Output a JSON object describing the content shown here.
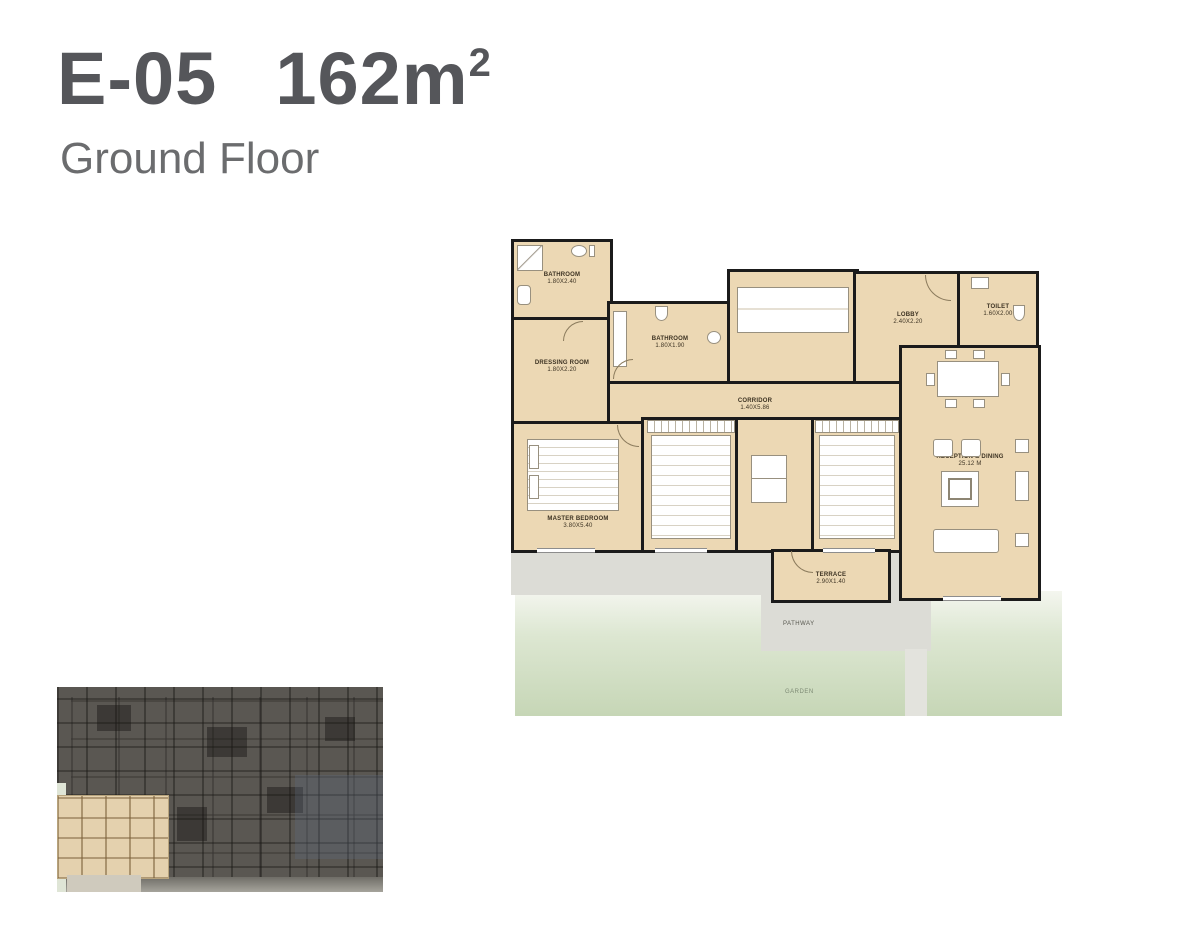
{
  "header": {
    "unit_code": "E-05",
    "area_value": "162m",
    "area_sup": "2",
    "subtitle": "Ground Floor"
  },
  "plan": {
    "rooms": [
      {
        "id": "bathroom-1",
        "label": "BATHROOM",
        "dims": "1.80X2.40"
      },
      {
        "id": "dressing-room",
        "label": "DRESSING ROOM",
        "dims": "1.80X2.20"
      },
      {
        "id": "bathroom-2",
        "label": "BATHROOM",
        "dims": "1.80X1.90"
      },
      {
        "id": "kitchen",
        "label": "KITCHEN",
        "dims": "2.80X3.80"
      },
      {
        "id": "lobby",
        "label": "LOBBY",
        "dims": "2.40X2.20"
      },
      {
        "id": "toilet",
        "label": "TOILET",
        "dims": "1.60X2.00"
      },
      {
        "id": "corridor",
        "label": "CORRIDOR",
        "dims": "1.40X5.86"
      },
      {
        "id": "master-bedroom",
        "label": "MASTER BEDROOM",
        "dims": "3.80X5.40"
      },
      {
        "id": "bedroom-2",
        "label": "BEDROOM 2",
        "dims": "4.40X3.60"
      },
      {
        "id": "bedroom-1",
        "label": "BEDROOM 1",
        "dims": "4.40X3.60"
      },
      {
        "id": "reception-dining",
        "label": "RECEPTION & DINING",
        "dims": "25.12 M"
      },
      {
        "id": "terrace",
        "label": "TERRACE",
        "dims": "2.90X1.40"
      }
    ],
    "outdoor": {
      "pathway": "PATHWAY",
      "garden": "GARDEN"
    }
  },
  "colors": {
    "title_text": "#55565a",
    "room_fill": "#ecd8b4",
    "wall": "#1b1b1b",
    "garden_green": "#c6d6b6",
    "pathway_gray": "#dcdcd6",
    "keyplan_dark": "#5a5752",
    "keyplan_highlight": "#e4d1ae"
  }
}
